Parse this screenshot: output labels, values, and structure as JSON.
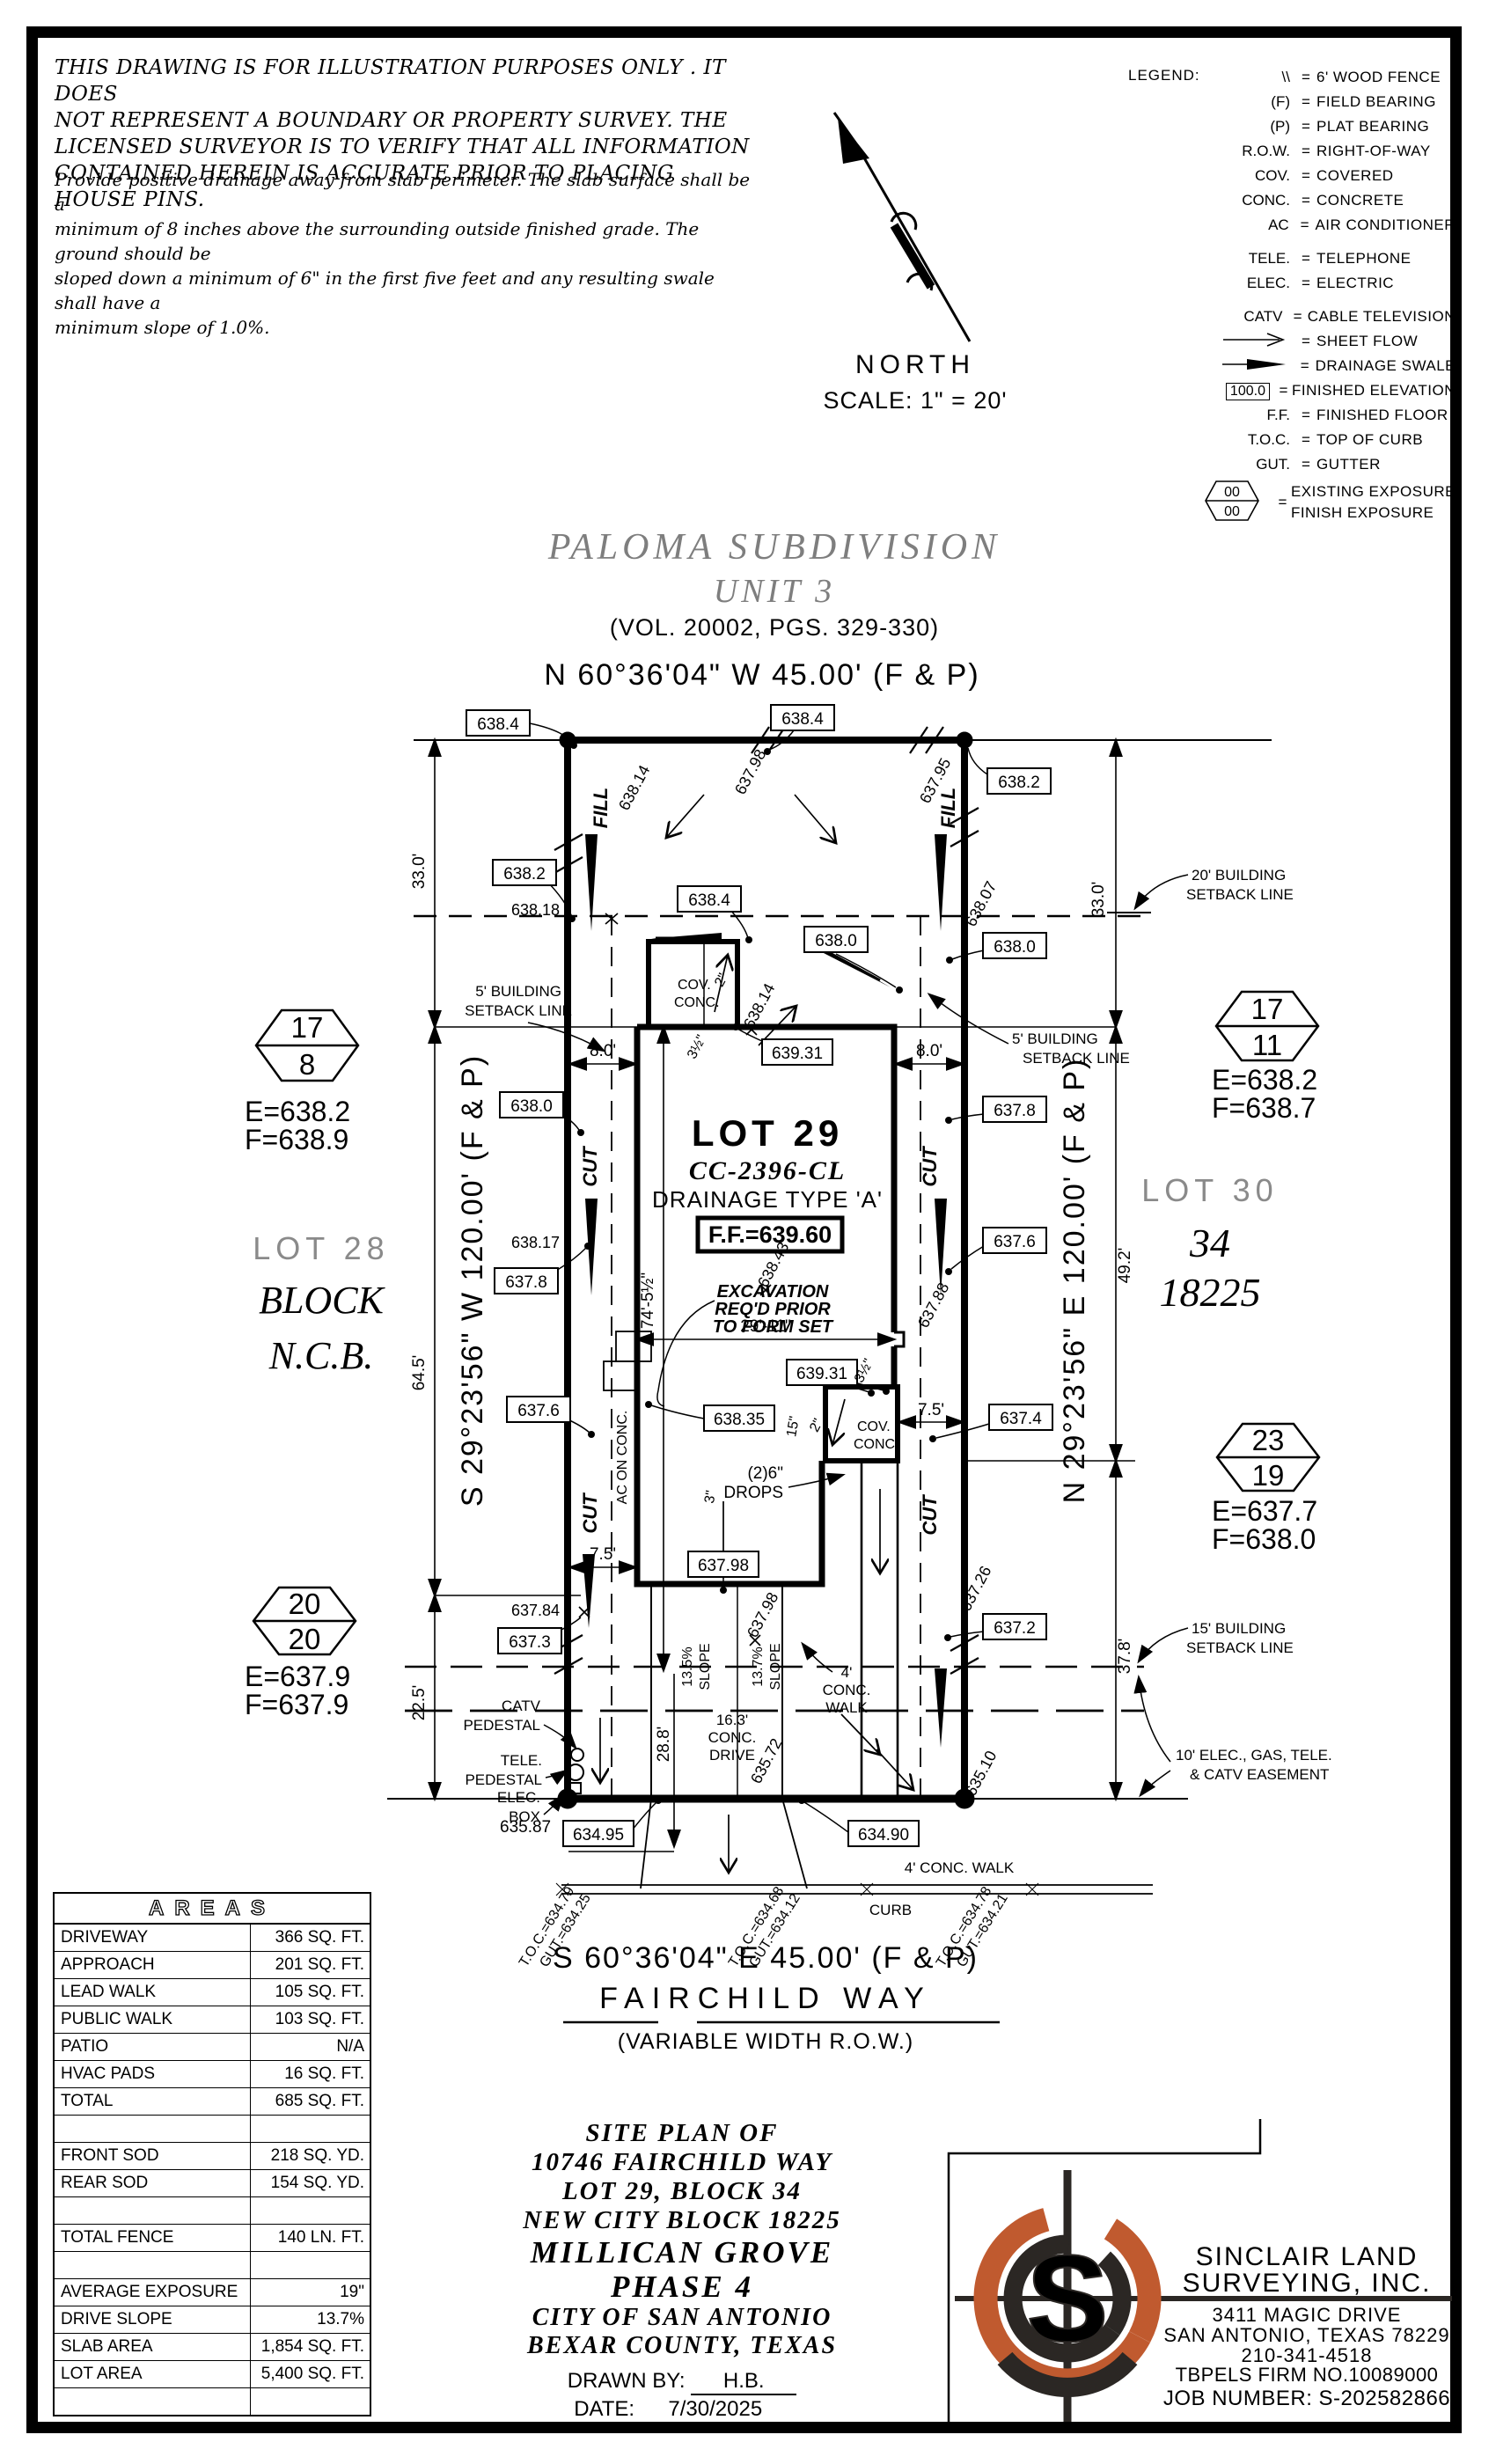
{
  "colors": {
    "accent": "#c05a2f",
    "gray": "#8a8a8a",
    "ink": "#000000"
  },
  "disclaimer": {
    "para1": [
      "THIS DRAWING IS FOR ILLUSTRATION PURPOSES ONLY . IT DOES",
      "NOT REPRESENT A BOUNDARY OR PROPERTY SURVEY. THE",
      "LICENSED SURVEYOR IS TO VERIFY THAT ALL INFORMATION",
      "CONTAINED HEREIN IS ACCURATE PRIOR TO PLACING HOUSE PINS."
    ],
    "para2": [
      "Provide positive drainage away from slab perimeter. The slab surface shall be a",
      "minimum of 8 inches above the surrounding outside finished grade. The ground should be",
      "sloped down a minimum of 6\" in the first five feet and any resulting swale shall have a",
      "minimum slope of 1.0%."
    ]
  },
  "legend": {
    "title": "LEGEND:",
    "eq": "=",
    "rows": [
      {
        "sym": "\\\\",
        "label": "6' WOOD FENCE"
      },
      {
        "sym": "(F)",
        "label": "FIELD BEARING"
      },
      {
        "sym": "(P)",
        "label": "PLAT BEARING"
      },
      {
        "sym": "R.O.W.",
        "label": "RIGHT-OF-WAY"
      },
      {
        "sym": "COV.",
        "label": "COVERED"
      },
      {
        "sym": "CONC.",
        "label": "CONCRETE"
      },
      {
        "sym": "AC",
        "label": "AIR CONDITIONER"
      },
      {
        "sym": "TELE.",
        "label": "TELEPHONE"
      },
      {
        "sym": "ELEC.",
        "label": "ELECTRIC"
      },
      {
        "sym": "CATV",
        "label": "CABLE TELEVISION"
      },
      {
        "sym": "sheet-flow-arrow",
        "label": "SHEET FLOW"
      },
      {
        "sym": "drainage-swale-arrow",
        "label": "DRAINAGE SWALE"
      },
      {
        "sym": "100.0",
        "label": "FINISHED ELEVATION"
      },
      {
        "sym": "F.F.",
        "label": "FINISHED FLOOR"
      },
      {
        "sym": "T.O.C.",
        "label": "TOP OF CURB"
      },
      {
        "sym": "GUT.",
        "label": "GUTTER"
      },
      {
        "sym": "00",
        "sym2": "00",
        "label": "EXISTING EXPOSURE",
        "label2": "FINISH EXPOSURE"
      }
    ]
  },
  "north": {
    "label": "NORTH",
    "scale": "SCALE: 1\" = 20'"
  },
  "subdivision": {
    "name": "PALOMA SUBDIVISION",
    "unit": "UNIT 3",
    "vol": "(VOL. 20002, PGS. 329-330)"
  },
  "bearings": {
    "top": "N 60°36'04\" W 45.00' (F & P)",
    "bottom": "S 60°36'04\" E 45.00' (F & P)",
    "left": "S 29°23'56\" W 120.00' (F & P)",
    "right": "N 29°23'56\" E 120.00' (F & P)"
  },
  "street": {
    "name": "FAIRCHILD WAY",
    "row": "(VARIABLE WIDTH R.O.W.)"
  },
  "adjacent": {
    "lot28": "LOT 28",
    "block": "BLOCK",
    "ncb": "N.C.B.",
    "lot30": "LOT 30",
    "block_num": "34",
    "ncb_num": "18225"
  },
  "markers": {
    "m17_8": {
      "top": "17",
      "bot": "8",
      "e": "E=638.2",
      "f": "F=638.9"
    },
    "m20_20": {
      "top": "20",
      "bot": "20",
      "e": "E=637.9",
      "f": "F=637.9"
    },
    "m17_11": {
      "top": "17",
      "bot": "11",
      "e": "E=638.2",
      "f": "F=638.7"
    },
    "m23_19": {
      "top": "23",
      "bot": "19",
      "e": "E=637.7",
      "f": "F=638.0"
    }
  },
  "lot": {
    "name": "LOT 29",
    "plan_code": "CC-2396-CL",
    "drainage": "DRAINAGE TYPE 'A'",
    "ff": "F.F.=639.60",
    "ex1": "EXCAVATION",
    "ex2": "REQ'D PRIOR",
    "ex3": "TO FORM SET"
  },
  "ann": {
    "v638_4": "638.4",
    "v638_2": "638.2",
    "v638_0": "638.0",
    "v637_8": "637.8",
    "v637_6": "637.6",
    "v637_4": "637.4",
    "v637_3": "637.3",
    "v637_2": "637.2",
    "v638_35": "638.35",
    "v639_31": "639.31",
    "v637_98": "637.98",
    "v634_95": "634.95",
    "v634_90": "634.90",
    "v638_14": "638.14",
    "v637_95": "637.95",
    "v638_07": "638.07",
    "v638_18": "638.18",
    "v638_17": "638.17",
    "v638_43": "638.43",
    "v637_88": "637.88",
    "v637_26": "637.26",
    "v637_84": "637.84",
    "v635_87": "635.87",
    "v635_72": "635.72",
    "v635_10": "635.10",
    "d33": "33.0'",
    "d8": "8.0'",
    "d64": "64.5'",
    "d49": "49.2'",
    "d37": "37.8'",
    "d22": "22.5'",
    "d7_5": "7.5'",
    "d74": "74'-5½\"",
    "d29": "29'-11\"",
    "d28": "28.8'",
    "d3h": "3½\"",
    "d2": "2\"",
    "d15": "15\"",
    "d3": "3\"",
    "drive1": "16.3'",
    "drive2": "CONC.",
    "drive3": "DRIVE",
    "slope135": "13.5%",
    "slope137": "13.7%",
    "slope": "SLOPE",
    "sb5a": "5' BUILDING",
    "sb20a": "20' BUILDING",
    "sb15a": "15' BUILDING",
    "sbb": "SETBACK LINE",
    "ease1": "10' ELEC., GAS, TELE.",
    "ease2": "& CATV EASEMENT",
    "catv": "CATV",
    "ped": "PEDESTAL",
    "tele": "TELE.",
    "elec": "ELEC.",
    "box": "BOX",
    "cov": "COV.",
    "conc": "CONC.",
    "drops1": "(2)6\"",
    "drops2": "DROPS",
    "walk4": "4' CONC. WALK",
    "w4a": "4'",
    "w4b": "CONC.",
    "w4c": "WALK",
    "curb": "CURB",
    "ac_on_conc": "AC ON CONC.",
    "fill": "FILL",
    "cut": "CUT",
    "toc1": "T.O.C.=634.79",
    "gut1": "GUT.=634.25",
    "toc2": "T.O.C.=634.68",
    "gut2": "GUT.=634.12",
    "toc3": "T.O.C.=634.78",
    "gut3": "GUT.=634.21"
  },
  "areas": {
    "title": "AREAS",
    "rows": [
      {
        "label": "DRIVEWAY",
        "value": "366 SQ. FT."
      },
      {
        "label": "APPROACH",
        "value": "201 SQ. FT."
      },
      {
        "label": "LEAD WALK",
        "value": "105 SQ. FT."
      },
      {
        "label": "PUBLIC WALK",
        "value": "103 SQ. FT."
      },
      {
        "label": "PATIO",
        "value": "N/A"
      },
      {
        "label": "HVAC PADS",
        "value": "16 SQ. FT."
      },
      {
        "label": "TOTAL",
        "value": "685 SQ. FT."
      },
      {
        "label": "",
        "value": ""
      },
      {
        "label": "FRONT SOD",
        "value": "218 SQ. YD."
      },
      {
        "label": "REAR SOD",
        "value": "154 SQ. YD."
      },
      {
        "label": "",
        "value": ""
      },
      {
        "label": "TOTAL FENCE",
        "value": "140 LN. FT."
      },
      {
        "label": "",
        "value": ""
      },
      {
        "label": "AVERAGE EXPOSURE",
        "value": "19\""
      },
      {
        "label": "DRIVE SLOPE",
        "value": "13.7%"
      },
      {
        "label": "SLAB AREA",
        "value": "1,854 SQ. FT."
      },
      {
        "label": "LOT AREA",
        "value": "5,400 SQ. FT."
      },
      {
        "label": "",
        "value": ""
      }
    ]
  },
  "title_block": {
    "l1": "SITE PLAN OF",
    "l2": "10746 FAIRCHILD WAY",
    "l3": "LOT 29, BLOCK 34",
    "l4": "NEW CITY BLOCK 18225",
    "l5": "MILLICAN GROVE",
    "l6": "PHASE 4",
    "l7": "CITY OF SAN ANTONIO",
    "l8": "BEXAR COUNTY, TEXAS",
    "drawn_label": "DRAWN BY:",
    "drawn": "H.B.",
    "date_label": "DATE:",
    "date": "7/30/2025"
  },
  "surveyor": {
    "name1": "SINCLAIR LAND",
    "name2": "SURVEYING, INC.",
    "addr1": "3411 MAGIC DRIVE",
    "addr2": "SAN ANTONIO, TEXAS 78229",
    "phone": "210-341-4518",
    "firm": "TBPELS FIRM NO.10089000",
    "job": "JOB NUMBER: S-202582866",
    "logo_letter": "S"
  }
}
